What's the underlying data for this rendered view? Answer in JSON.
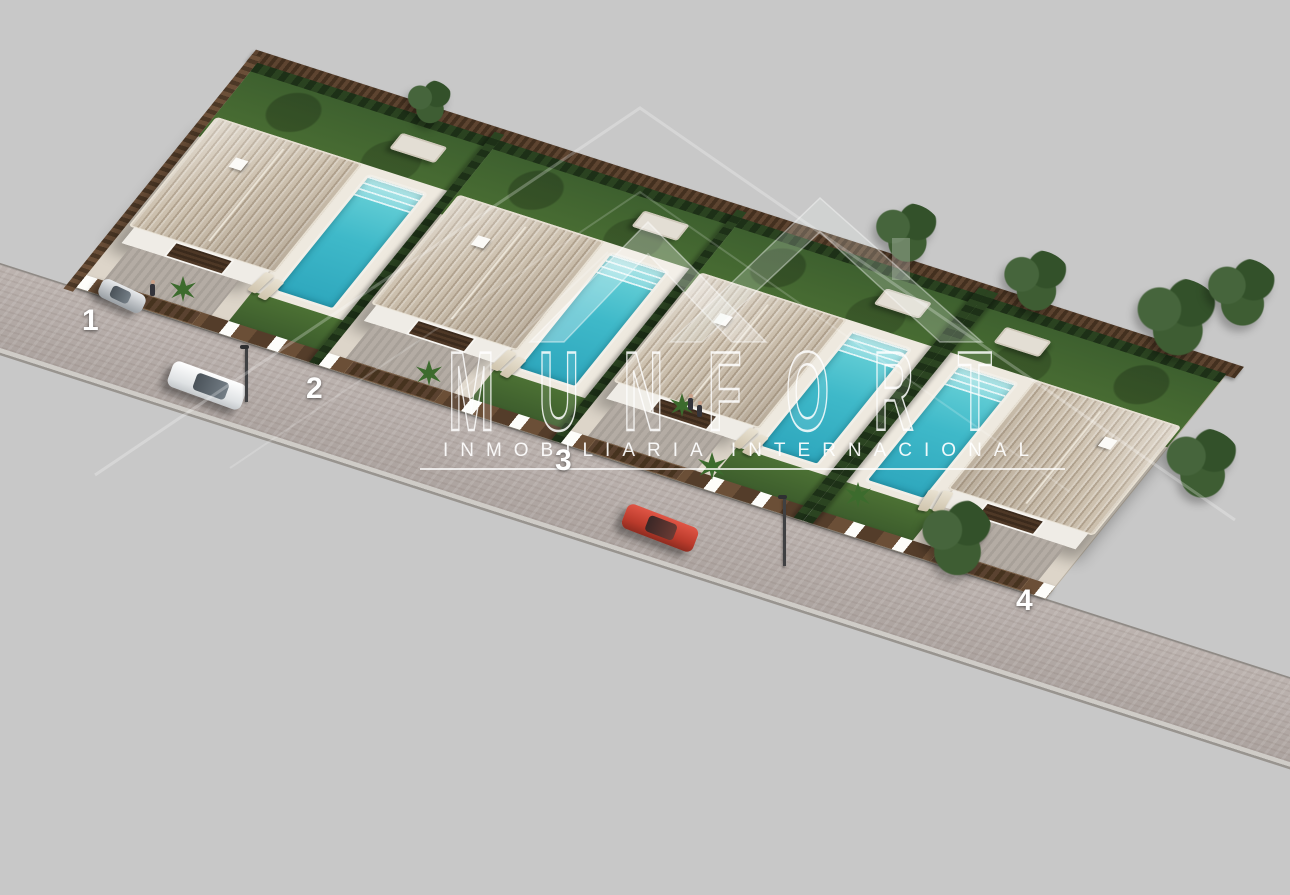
{
  "watermark": {
    "brand": "MUNFORT",
    "tagline": "INMOBILIARIA INTERNACIONAL",
    "color": "#ffffff"
  },
  "villas": [
    {
      "label": "1"
    },
    {
      "label": "2"
    },
    {
      "label": "3"
    },
    {
      "label": "4"
    }
  ],
  "scene_colors": {
    "background": "#c8c8c8",
    "street": "#b3aaa6",
    "roof_tile": "#cdc1af",
    "wall": "#f4f2ee",
    "pool_water": "#3fb9c9",
    "grass": "#4c7134",
    "hedge": "#1d3017",
    "wood_fence": "#6b4f38",
    "red_car": "#b93a2b",
    "white_car": "#e8eaec"
  }
}
